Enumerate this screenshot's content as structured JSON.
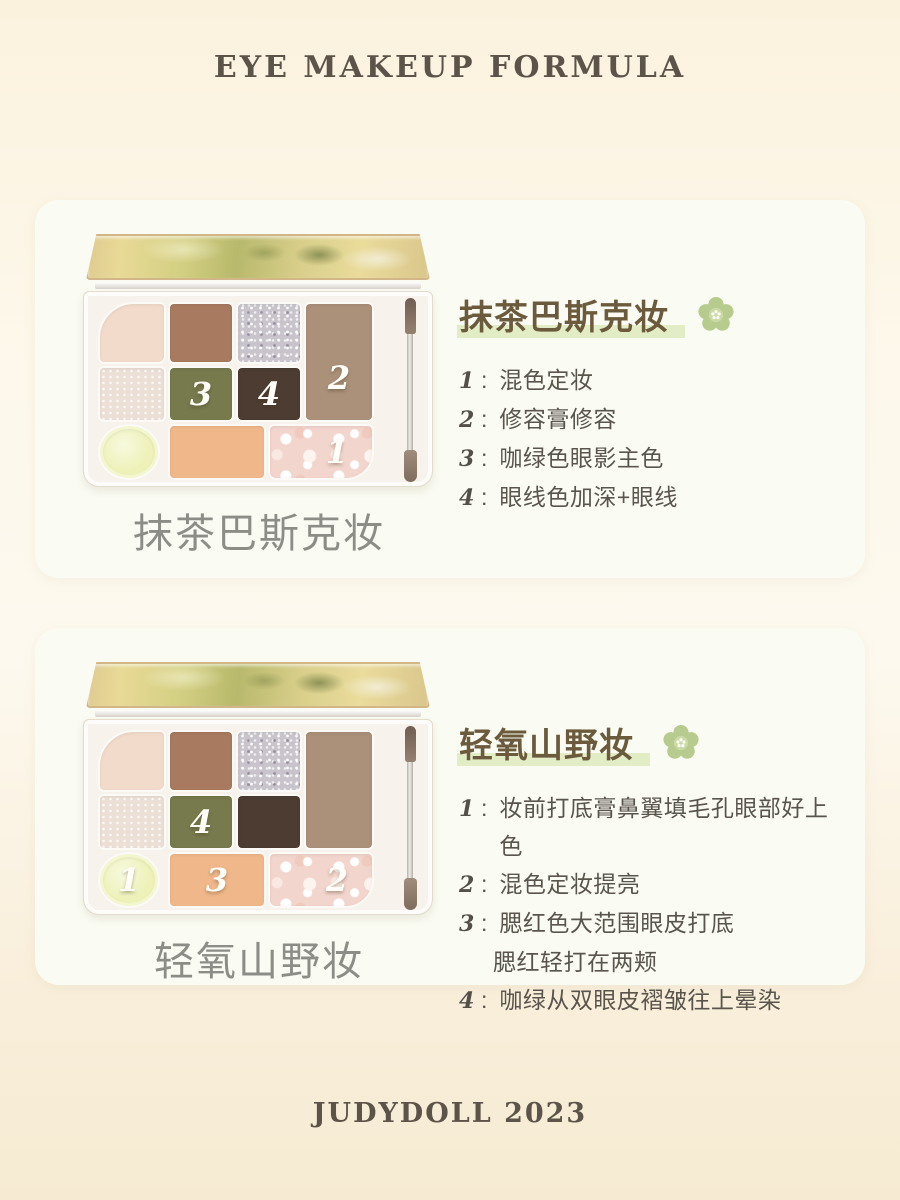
{
  "header": {
    "title": "EYE MAKEUP FORMULA"
  },
  "footer": {
    "brand": "JUDYDOLL 2023"
  },
  "colon": ":",
  "colors": {
    "accent_green": "#b7cb8e",
    "flower_center": "#cbd9a4",
    "highlight_green": "#e3edc5",
    "heading_brown": "#6b5a3c",
    "step_text": "#59544c",
    "caption_gray": "#8d8d88",
    "title_brown": "#5c5349",
    "card_bg": "#fafcf3"
  },
  "pan_colors": {
    "pink": "#f3dbcb",
    "brown": "#a87a60",
    "silver": "#c9c4cc",
    "taupe": "#ab9179",
    "champagne": "#ecdfd6",
    "olive": "#767a4c",
    "dark_brown": "#4c3c31",
    "cream": "#eef2b9",
    "peach": "#f0b88a",
    "marble": "#f2d5cc"
  },
  "cards": [
    {
      "heading": "抹茶巴斯克妆",
      "caption": "抹茶巴斯克妆",
      "steps": [
        {
          "num": "1",
          "text": "混色定妆"
        },
        {
          "num": "2",
          "text": "修容膏修容"
        },
        {
          "num": "3",
          "text": "咖绿色眼影主色"
        },
        {
          "num": "4",
          "text": "眼线色加深+眼线"
        }
      ],
      "pan_labels": {
        "circle": "",
        "peach": "",
        "marble": "1",
        "taupe": "2",
        "olive": "3",
        "dark_brown": "4"
      }
    },
    {
      "heading": "轻氧山野妆",
      "caption": "轻氧山野妆",
      "steps": [
        {
          "num": "1",
          "text": "妆前打底膏鼻翼填毛孔眼部好上色"
        },
        {
          "num": "2",
          "text": "混色定妆提亮"
        },
        {
          "num": "3",
          "text": "腮红色大范围眼皮打底",
          "text2": "腮红轻打在两颊"
        },
        {
          "num": "4",
          "text": "咖绿从双眼皮褶皱往上晕染"
        }
      ],
      "pan_labels": {
        "circle": "1",
        "peach": "3",
        "marble": "2",
        "taupe": "",
        "olive": "4",
        "dark_brown": ""
      }
    }
  ]
}
